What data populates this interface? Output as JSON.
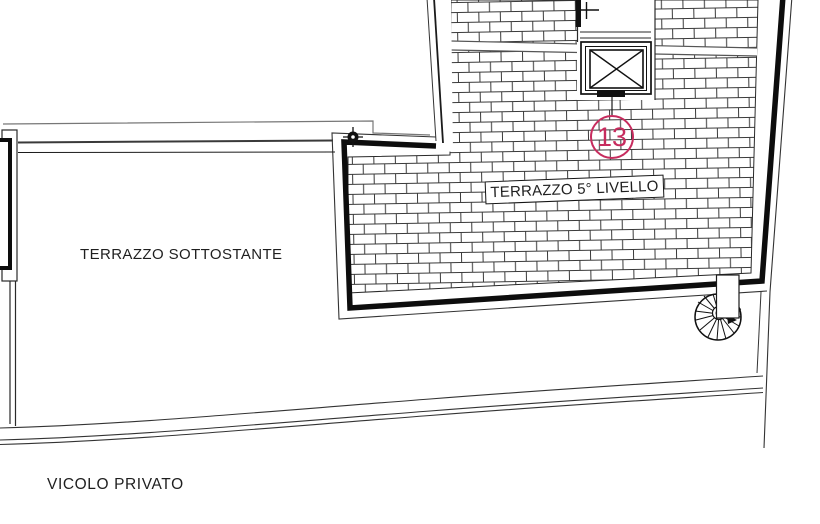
{
  "plan": {
    "labels": {
      "upper_terrace": "TERRAZZO 5° LIVELLO",
      "lower_terrace": "TERRAZZO SOTTOSTANTE",
      "street": "VICOLO PRIVATO",
      "unit_number": "13"
    },
    "colors": {
      "line": "#1b1b1b",
      "annotation": "#c72c5e",
      "background": "#ffffff"
    },
    "icons": {
      "elevator": "elevator-cross-icon",
      "staircase": "spiral-staircase-icon",
      "survey_marks": "survey-cross-icon"
    }
  }
}
